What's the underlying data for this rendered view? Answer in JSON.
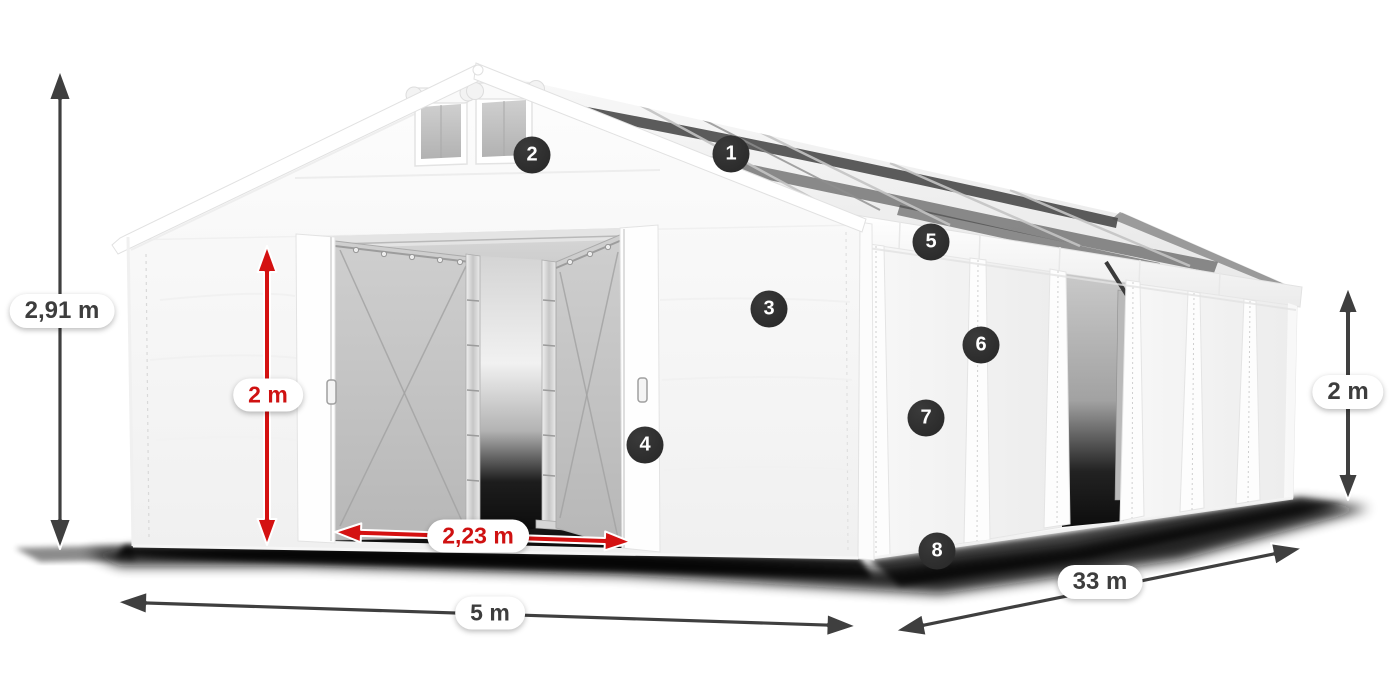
{
  "canvas": {
    "width": 1400,
    "height": 700,
    "background": "#ffffff"
  },
  "product": {
    "description": "white storage tent with open front doors and side entrance, 8 numbered feature callouts and dimension arrows"
  },
  "colors": {
    "accent_red": "#d41111",
    "arrow_dark": "#3f3f3f",
    "badge_bg": "#2e2e2e",
    "label_bg": "#ffffff",
    "label_text_dark": "#3d3d3d",
    "label_text_red": "#cf1111",
    "tent_white": "#f7f7f7"
  },
  "callouts": [
    {
      "number": "1",
      "x": 731,
      "y": 154
    },
    {
      "number": "2",
      "x": 532,
      "y": 155
    },
    {
      "number": "3",
      "x": 769,
      "y": 309
    },
    {
      "number": "4",
      "x": 645,
      "y": 445
    },
    {
      "number": "5",
      "x": 931,
      "y": 242
    },
    {
      "number": "6",
      "x": 981,
      "y": 345
    },
    {
      "number": "7",
      "x": 926,
      "y": 418
    },
    {
      "number": "8",
      "x": 937,
      "y": 551
    }
  ],
  "dimensions": [
    {
      "id": "total-height",
      "label": "2,91 m",
      "style": "dark",
      "orientation": "vertical"
    },
    {
      "id": "door-height",
      "label": "2 m",
      "style": "red",
      "orientation": "vertical"
    },
    {
      "id": "door-width",
      "label": "2,23 m",
      "style": "red",
      "orientation": "horizontal"
    },
    {
      "id": "tent-width",
      "label": "5 m",
      "style": "dark",
      "orientation": "horizontal"
    },
    {
      "id": "tent-length",
      "label": "33 m",
      "style": "dark",
      "orientation": "diagonal"
    },
    {
      "id": "side-height",
      "label": "2 m",
      "style": "dark",
      "orientation": "vertical"
    }
  ]
}
